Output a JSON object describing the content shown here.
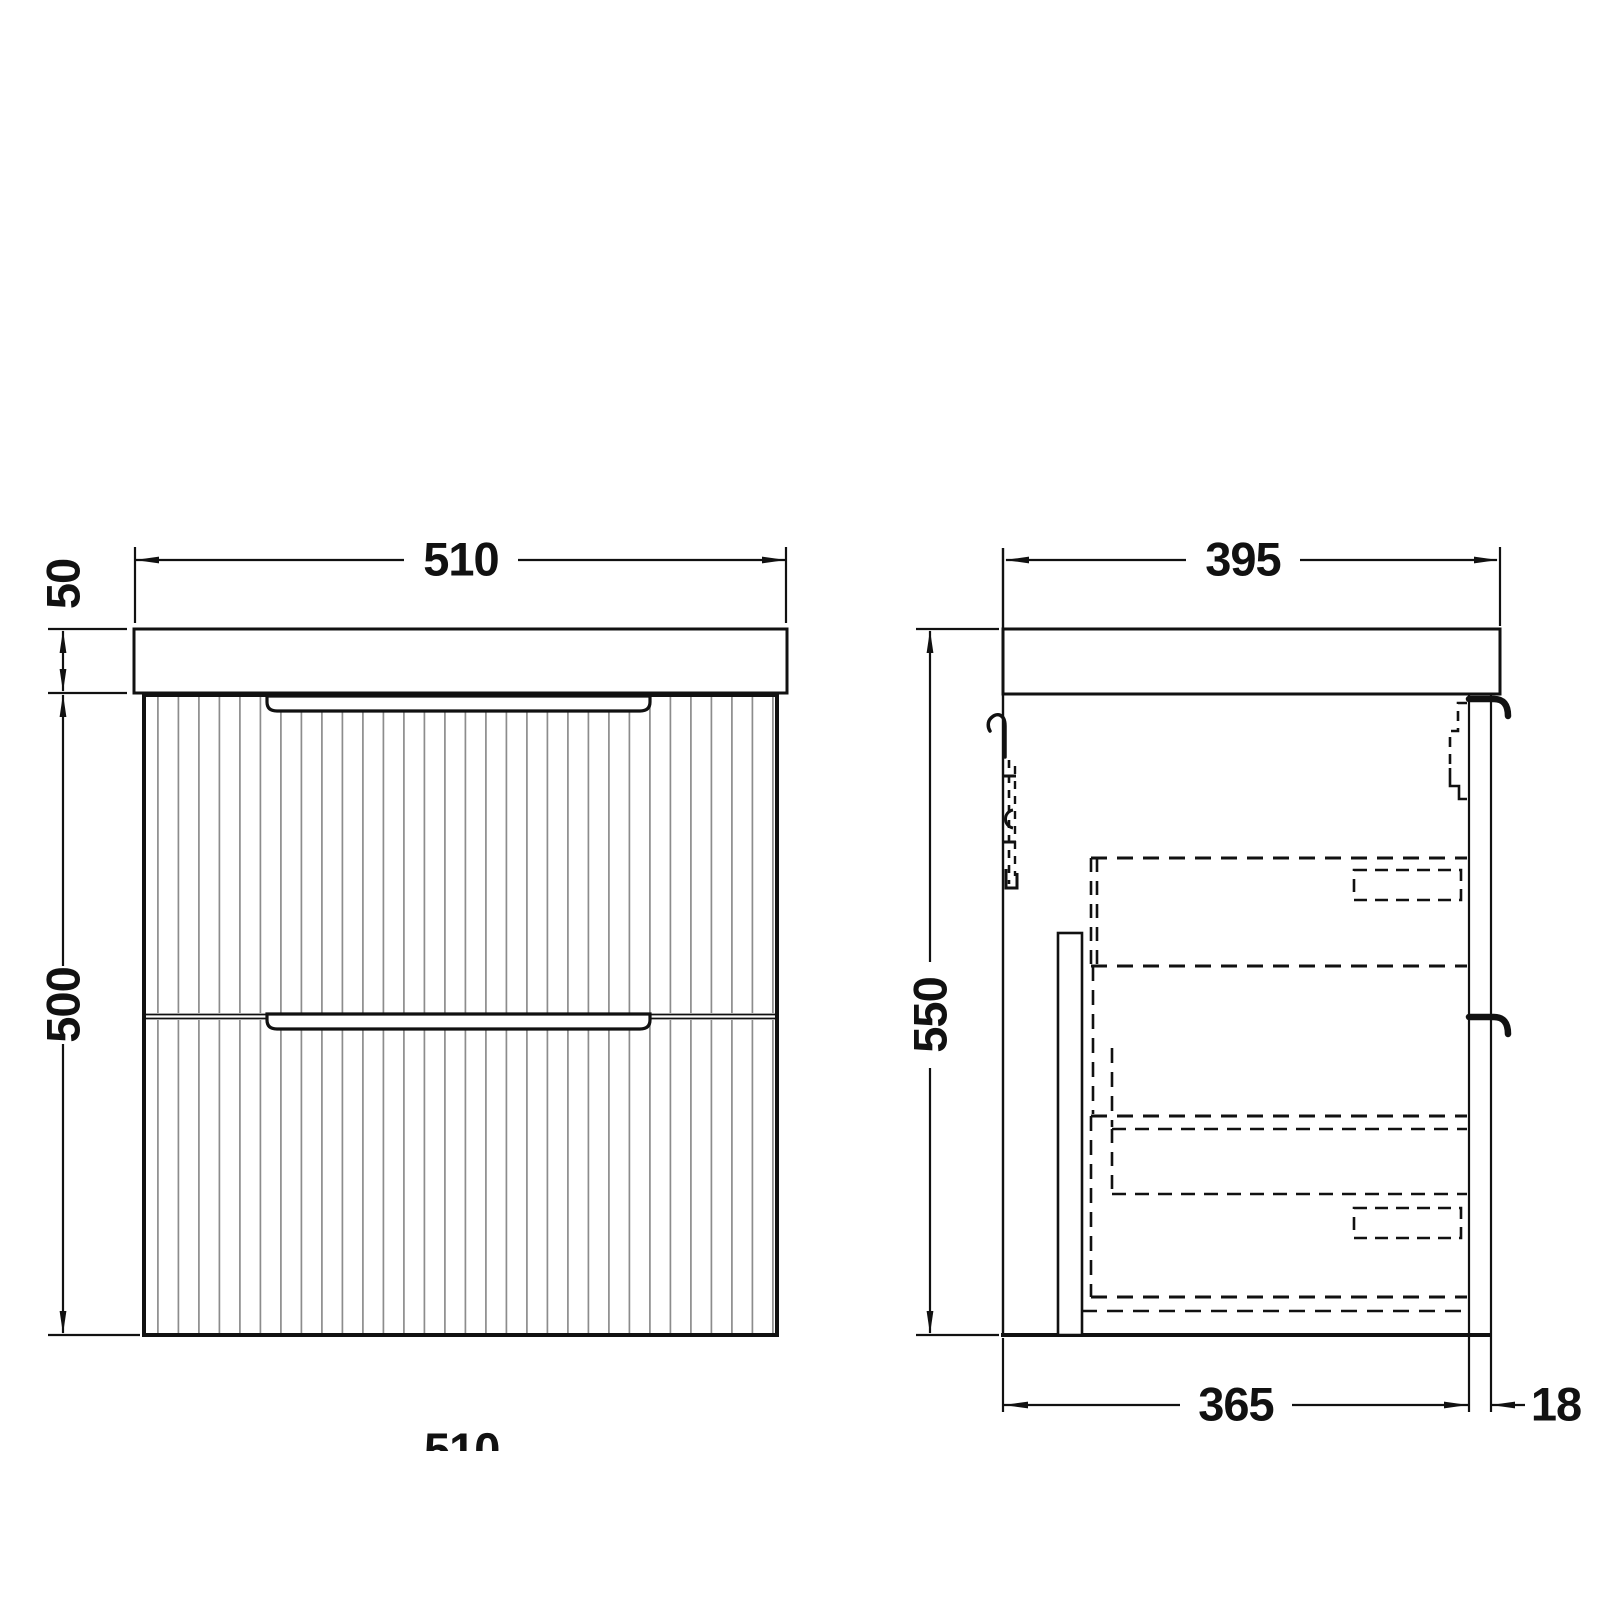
{
  "drawing": {
    "background": "#ffffff",
    "line_color": "#111111",
    "flute_color": "#8c8c8c",
    "labels": {
      "front_width": "510",
      "front_counter_height": "50",
      "front_cabinet_height": "500",
      "front_width_partial": "510",
      "side_depth": "395",
      "side_height": "550",
      "side_inner_depth": "365",
      "side_panel_thickness": "18"
    }
  }
}
